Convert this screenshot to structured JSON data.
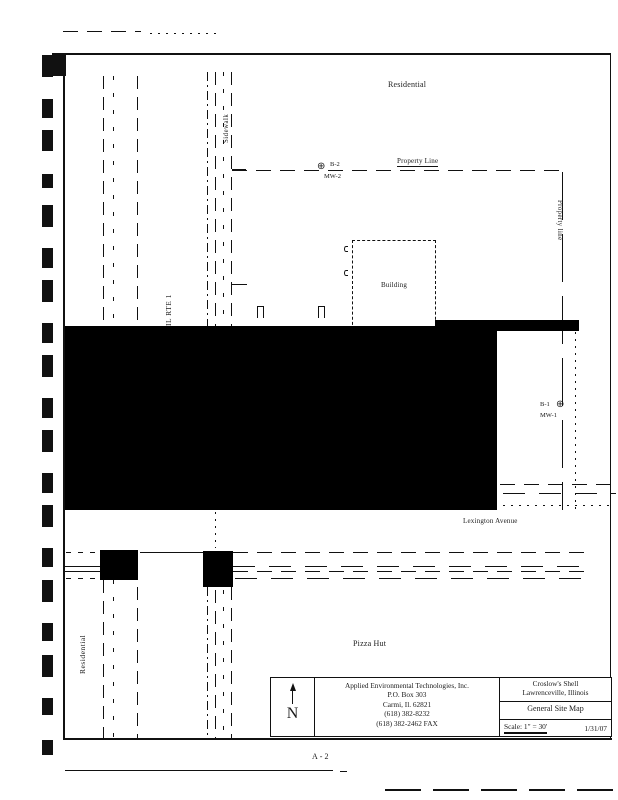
{
  "drawing": {
    "labels": {
      "residential_top": "Residential",
      "residential_left": "Residential",
      "property_line_top": "Property Line",
      "property_line_right": "Property line",
      "il_rte_1": "IL RTE 1",
      "sidewalk": "Sidewalk",
      "building": "Building",
      "lexington_avenue": "Lexington Avenue",
      "pizza_hut": "Pizza Hut"
    },
    "wells": [
      {
        "boring": "B-2",
        "well": "MW-2"
      },
      {
        "boring": "B-1",
        "well": "MW-1"
      }
    ],
    "page_number": "A-2"
  },
  "title_block": {
    "north_label": "N",
    "company": {
      "name": "Applied Environmental Technologies, Inc.",
      "address1": "P.O. Box 303",
      "address2": "Carmi, Il. 62821",
      "phone": "(618) 382-8232",
      "fax": "(618) 382-2462 FAX"
    },
    "project": {
      "client": "Croslow's Shell",
      "location": "Lawrenceville, Illinois",
      "title": "General Site Map",
      "scale": "Scale: 1\" = 30'",
      "date": "1/31/07"
    }
  },
  "icons": {
    "north_arrow": "up-arrow",
    "monitoring_well": "circle-cross",
    "well_glyph": "⊕"
  },
  "colors": {
    "ink": "#1a1a1a",
    "paper": "#ffffff",
    "redaction": "#000000"
  }
}
